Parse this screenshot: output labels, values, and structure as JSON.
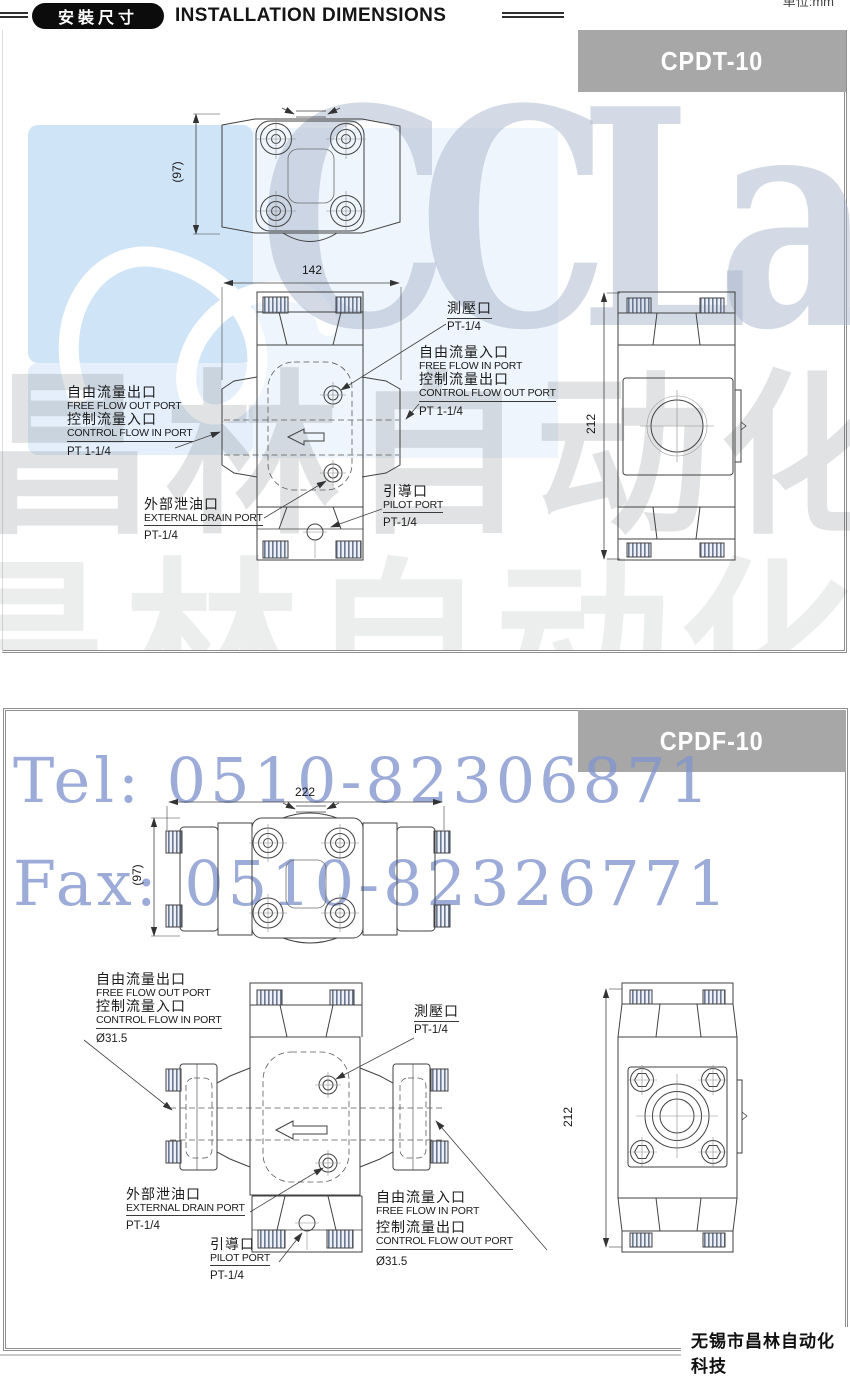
{
  "meta": {
    "unit_note": "单位:mm"
  },
  "header": {
    "badge": "安裝尺寸",
    "title": "INSTALLATION DIMENSIONS"
  },
  "watermark": {
    "logo_text": "CCLair",
    "tel": "Tel: 0510-82306871",
    "fax": "Fax: 0510-82326771",
    "brand_cn": "昌林自动化",
    "blue": "#cfe4f7",
    "text_blue": "#8093cd",
    "gray": "#d9d9d9"
  },
  "footer": {
    "company": "无锡市昌林自动化科技"
  },
  "sections": [
    {
      "model": "CPDT-10",
      "dims": {
        "width": "142",
        "height": "212",
        "depth": "(97)"
      },
      "labels": {
        "test_zh": "測壓口",
        "test_size": "PT-1/4",
        "free_in_zh": "自由流量入口",
        "free_in_en": "FREE FLOW IN PORT",
        "ctrl_out_zh": "控制流量出口",
        "ctrl_out_en": "CONTROL FLOW OUT PORT",
        "in_size": "PT 1-1/4",
        "free_out_zh": "自由流量出口",
        "free_out_en": "FREE FLOW OUT PORT",
        "ctrl_in_zh": "控制流量入口",
        "ctrl_in_en": "CONTROL FLOW IN PORT",
        "out_size": "PT 1-1/4",
        "drain_zh": "外部泄油口",
        "drain_en": "EXTERNAL DRAIN PORT",
        "drain_size": "PT-1/4",
        "pilot_zh": "引導口",
        "pilot_en": "PILOT PORT",
        "pilot_size": "PT-1/4"
      }
    },
    {
      "model": "CPDF-10",
      "dims": {
        "width": "222",
        "height": "212",
        "depth": "(97)"
      },
      "labels": {
        "test_zh": "測壓口",
        "test_size": "PT-1/4",
        "free_in_zh": "自由流量入口",
        "free_in_en": "FREE FLOW IN PORT",
        "ctrl_out_zh": "控制流量出口",
        "ctrl_out_en": "CONTROL FLOW OUT PORT",
        "in_size": "Ø31.5",
        "free_out_zh": "自由流量出口",
        "free_out_en": "FREE FLOW OUT PORT",
        "ctrl_in_zh": "控制流量入口",
        "ctrl_in_en": "CONTROL FLOW IN PORT",
        "out_size": "Ø31.5",
        "drain_zh": "外部泄油口",
        "drain_en": "EXTERNAL DRAIN PORT",
        "drain_size": "PT-1/4",
        "pilot_zh": "引導口",
        "pilot_en": "PILOT PORT",
        "pilot_size": "PT-1/4"
      }
    }
  ]
}
